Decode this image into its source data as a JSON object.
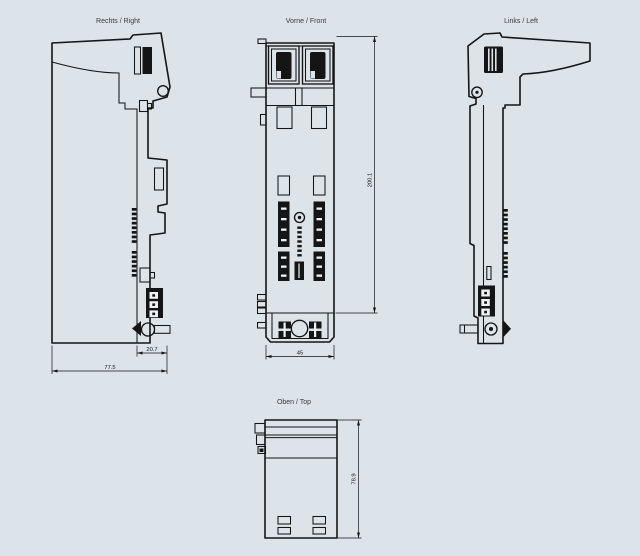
{
  "page": {
    "background": "#dce3e9",
    "line_color": "#151515"
  },
  "views": {
    "right": {
      "label": "Rechts / Right",
      "dims": {
        "total_depth": "77.5",
        "rear_depth": "20.7"
      }
    },
    "front": {
      "label": "Vorne / Front",
      "dims": {
        "width": "45",
        "height": "200.1"
      }
    },
    "left": {
      "label": "Links / Left"
    },
    "top": {
      "label": "Oben / Top",
      "dims": {
        "depth": "78.9"
      }
    }
  }
}
